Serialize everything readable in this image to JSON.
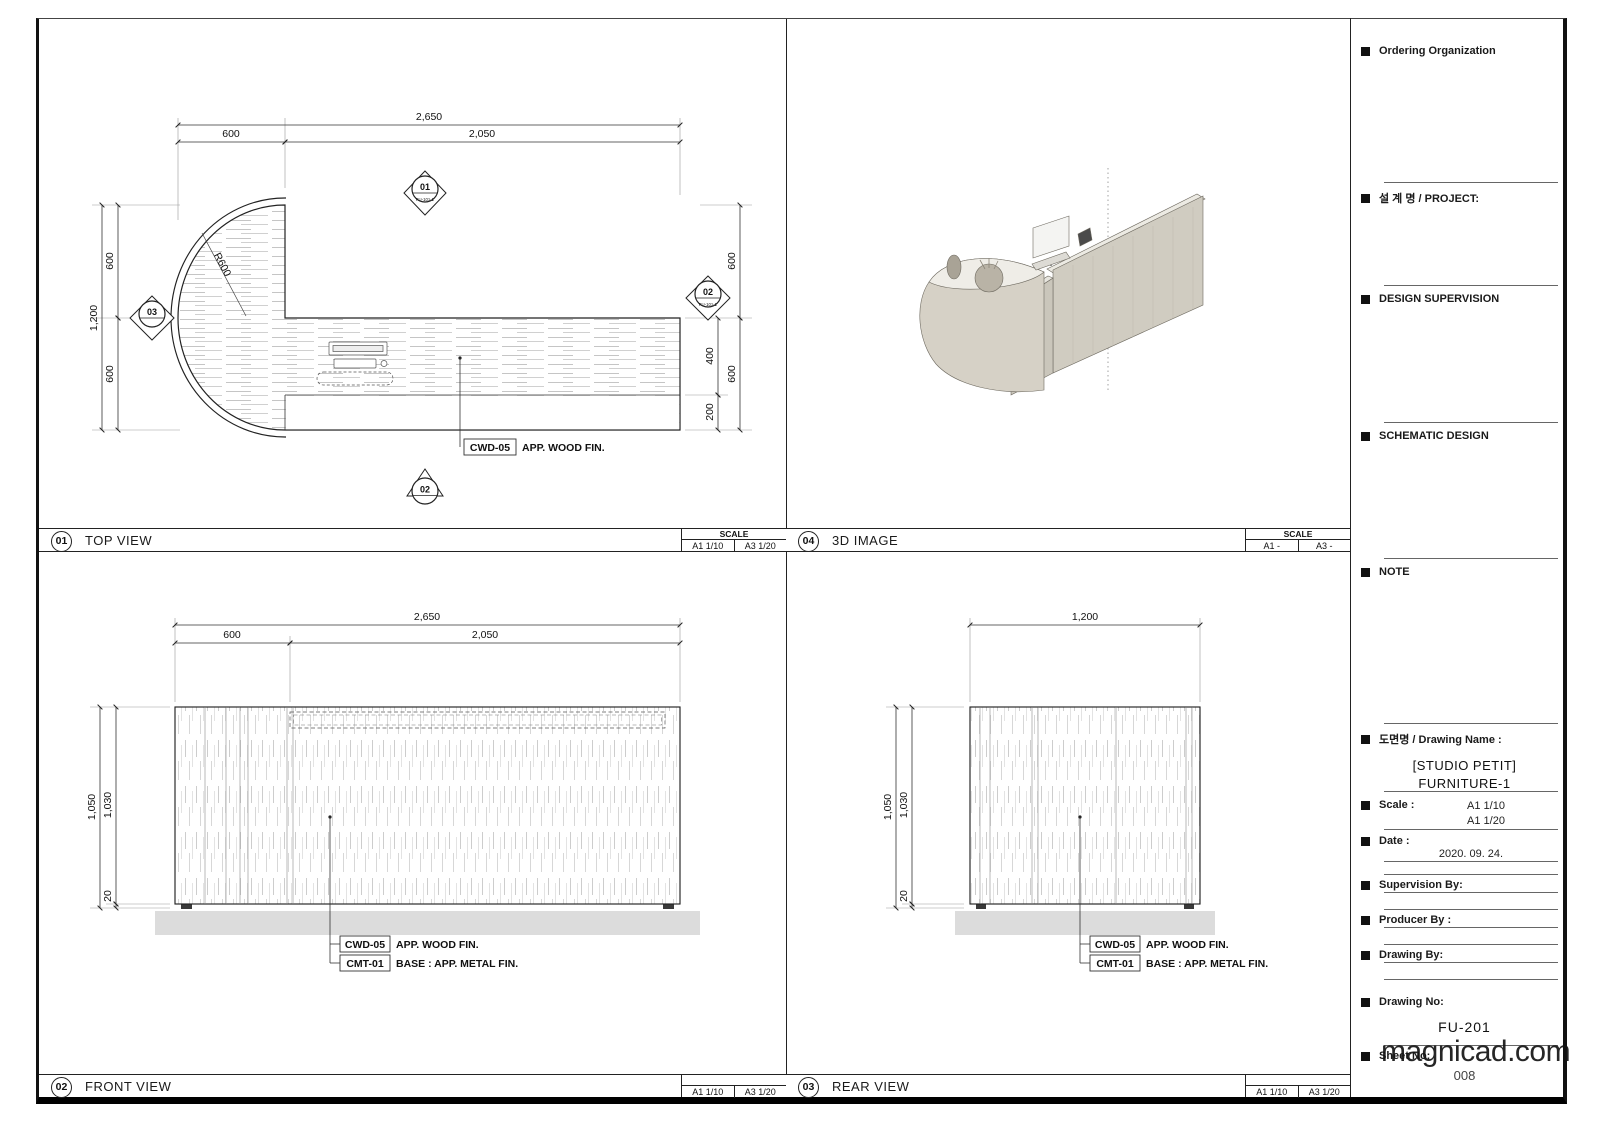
{
  "watermark": "magnicad.com",
  "panels": {
    "top_view": {
      "no": "01",
      "title": "TOP VIEW",
      "scale_header": "SCALE",
      "scale_a1": "A1 1/10",
      "scale_a3": "A3 1/20",
      "dims": {
        "total_w": "2,650",
        "w_left": "600",
        "w_right": "2,050",
        "total_d": "1,200",
        "d_top": "600",
        "d_bottom": "600",
        "r_top": "600",
        "r_bottom": "600",
        "counter": "400",
        "shelf": "200",
        "radius": "R600"
      },
      "callout_code": "CWD-05",
      "callout_text": "APP. WOOD FIN.",
      "markers": {
        "top_no": "01",
        "top_ref": "FU-101-1",
        "right_no": "02",
        "right_ref": "FU-101-1",
        "left_no": "03",
        "bottom_no": "02"
      }
    },
    "image3d": {
      "no": "04",
      "title": "3D IMAGE",
      "scale_header": "SCALE",
      "scale_a1": "A1 -",
      "scale_a3": "A3 -"
    },
    "front_view": {
      "no": "02",
      "title": "FRONT VIEW",
      "scale_a1": "A1 1/10",
      "scale_a3": "A3 1/20",
      "dims": {
        "total_w": "2,650",
        "w_left": "600",
        "w_right": "2,050",
        "h_total": "1,050",
        "h_body": "1,030",
        "h_base": "20"
      },
      "callout1_code": "CWD-05",
      "callout1_text": "APP. WOOD FIN.",
      "callout2_code": "CMT-01",
      "callout2_text": "BASE : APP. METAL FIN."
    },
    "rear_view": {
      "no": "03",
      "title": "REAR VIEW",
      "scale_a1": "A1 1/10",
      "scale_a3": "A3 1/20",
      "dims": {
        "total_w": "1,200",
        "h_total": "1,050",
        "h_body": "1,030",
        "h_base": "20"
      },
      "callout1_code": "CWD-05",
      "callout1_text": "APP. WOOD FIN.",
      "callout2_code": "CMT-01",
      "callout2_text": "BASE : APP. METAL FIN."
    }
  },
  "titleblock": {
    "ordering_org": "Ordering Organization",
    "project": "설 계 명 / PROJECT:",
    "design_supervision": "DESIGN SUPERVISION",
    "schematic_design": "SCHEMATIC DESIGN",
    "note": "NOTE",
    "drawing_name_label": "도면명 / Drawing Name :",
    "drawing_name_line1": "[STUDIO PETIT]",
    "drawing_name_line2": "FURNITURE-1",
    "scale_label": "Scale :",
    "scale_value1": "A1 1/10",
    "scale_value2": "A1 1/20",
    "date_label": "Date :",
    "date_value": "2020. 09. 24.",
    "supervision_label": "Supervision By:",
    "producer_label": "Producer By :",
    "drawing_by_label": "Drawing By:",
    "drawing_no_label": "Drawing No:",
    "drawing_no": "FU-201",
    "sheet_no_label": "Sheet No:",
    "sheet_no": "008"
  }
}
